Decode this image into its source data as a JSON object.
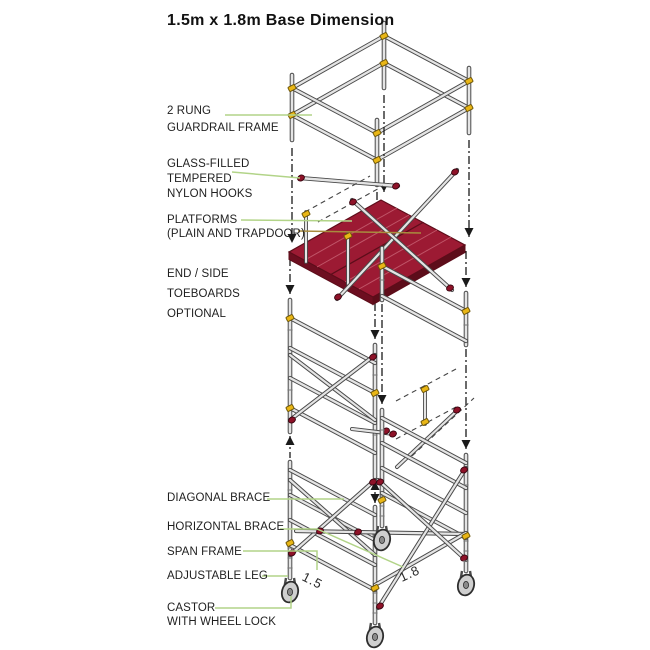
{
  "title": {
    "line1": "1.5m x 1.8m",
    "line2": "Base Dimension"
  },
  "labels": {
    "rung_guardrail": {
      "lines": [
        "2 RUNG",
        "GUARDRAIL FRAME"
      ]
    },
    "nylon_hooks": {
      "lines": [
        "GLASS-FILLED",
        "TEMPERED",
        "NYLON HOOKS"
      ]
    },
    "platforms": {
      "lines": [
        "PLATFORMS",
        "(PLAIN AND TRAPDOOR)"
      ]
    },
    "toeboards": {
      "lines": [
        "END / SIDE",
        "TOEBOARDS",
        "OPTIONAL"
      ]
    },
    "diagonal_brace": {
      "lines": [
        "DIAGONAL BRACE"
      ]
    },
    "horizontal_brace": {
      "lines": [
        "HORIZONTAL BRACE"
      ]
    },
    "span_frame": {
      "lines": [
        "SPAN FRAME"
      ]
    },
    "adjustable_leg": {
      "lines": [
        "ADJUSTABLE LEG"
      ]
    },
    "castor": {
      "lines": [
        "CASTOR",
        "WITH WHEEL LOCK"
      ]
    }
  },
  "dimensions": {
    "width": "1.5",
    "depth": "1.8"
  },
  "colors": {
    "leader": "#b2d488",
    "leader_alt": "#a88c3e",
    "platform_red": "#9c1a33",
    "platform_red_dark": "#6d0e20",
    "platform_red_edge": "#5d0d1a",
    "plank_highlight": "#c05568",
    "hook_red": "#8e1228",
    "clamp_yellow": "#e9b616",
    "tube_fill": "#e4e4e4",
    "tube_outline": "#4a4a4a",
    "arrow_black": "#1a1a1a"
  }
}
